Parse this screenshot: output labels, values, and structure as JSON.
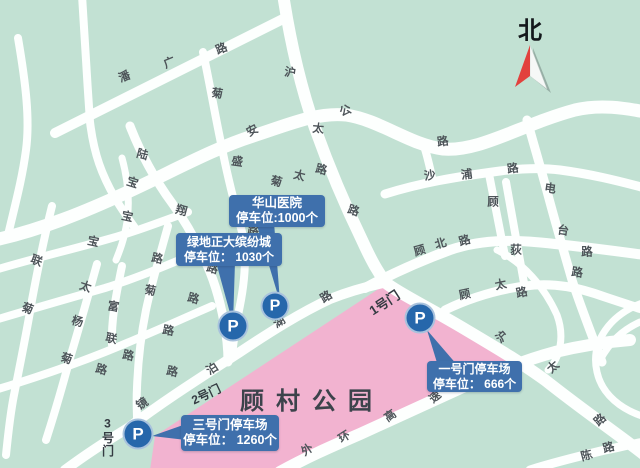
{
  "map": {
    "title": "顾村公园",
    "north_label": "北",
    "parking_letter": "P",
    "gates": {
      "g1": "1号门",
      "g2": "2号门",
      "g3": "3号门"
    },
    "callouts": {
      "huashan": {
        "line1": "华山医院",
        "line2": "停车位:1000个"
      },
      "lvdi": {
        "line1": "绿地正大缤纷城",
        "line2": "停车位： 1030个"
      },
      "gate3": {
        "line1": "三号门停车场",
        "line2": "停车位： 1260个"
      },
      "gate1": {
        "line1": "一号门停车场",
        "line2": "停车位： 666个"
      }
    },
    "colors": {
      "bg": "#c2e1d3",
      "road": "#fdfffe",
      "park": "#f2b3d0",
      "callout": "#3f70ac",
      "p-blue": "#2667ab",
      "compass-red": "#e2413d",
      "ink": "#343b42",
      "road-label": "#4d5459",
      "title": "#3c434b"
    },
    "road_labels": [
      {
        "t": "潘",
        "x": 125,
        "y": 78,
        "r": -22,
        "road": "潘广路"
      },
      {
        "t": "广",
        "x": 170,
        "y": 64,
        "r": -22,
        "road": "潘广路"
      },
      {
        "t": "路",
        "x": 222,
        "y": 50,
        "r": -22,
        "road": "潘广路"
      },
      {
        "t": "沪",
        "x": 290,
        "y": 74,
        "r": 8,
        "road": "沪太公路"
      },
      {
        "t": "太",
        "x": 318,
        "y": 130,
        "r": 5,
        "road": "沪太公路"
      },
      {
        "t": "路",
        "x": 353,
        "y": 212,
        "r": 18,
        "road": "沪太公路"
      },
      {
        "t": "沪",
        "x": 503,
        "y": 338,
        "r": -42,
        "road": "沪太公路"
      },
      {
        "t": "太",
        "x": 554,
        "y": 368,
        "r": -42,
        "road": "沪太公路"
      },
      {
        "t": "路",
        "x": 601,
        "y": 421,
        "r": -42,
        "road": "沪太公路"
      },
      {
        "t": "宝",
        "x": 132,
        "y": 184,
        "r": 18,
        "road": "宝安公路"
      },
      {
        "t": "安",
        "x": 253,
        "y": 132,
        "r": -28,
        "road": "宝安公路"
      },
      {
        "t": "公",
        "x": 346,
        "y": 112,
        "r": -22,
        "road": "宝安公路"
      },
      {
        "t": "路",
        "x": 443,
        "y": 143,
        "r": -8,
        "road": "宝安公路"
      },
      {
        "t": "菊",
        "x": 217,
        "y": 95,
        "r": 8,
        "road": "菊盛路"
      },
      {
        "t": "盛",
        "x": 237,
        "y": 163,
        "r": 8,
        "road": "菊盛路"
      },
      {
        "t": "路",
        "x": 253,
        "y": 232,
        "r": 8,
        "road": "菊盛路"
      },
      {
        "t": "陆",
        "x": 142,
        "y": 156,
        "r": 15,
        "road": "陆翔路"
      },
      {
        "t": "翔",
        "x": 181,
        "y": 212,
        "r": 15,
        "road": "陆翔路"
      },
      {
        "t": "路",
        "x": 212,
        "y": 270,
        "r": 15,
        "road": "陆翔路"
      },
      {
        "t": "宝",
        "x": 127,
        "y": 218,
        "r": 12,
        "road": ""
      },
      {
        "t": "路",
        "x": 157,
        "y": 260,
        "r": 12,
        "road": ""
      },
      {
        "t": "菊",
        "x": 276,
        "y": 183,
        "r": 14,
        "road": "菊太路"
      },
      {
        "t": "太",
        "x": 299,
        "y": 177,
        "r": 14,
        "road": "菊太路"
      },
      {
        "t": "路",
        "x": 321,
        "y": 171,
        "r": 14,
        "road": "菊太路"
      },
      {
        "t": "联",
        "x": 36,
        "y": 262,
        "r": 20,
        "road": "菊联路"
      },
      {
        "t": "菊",
        "x": 27,
        "y": 310,
        "r": 20,
        "road": "菊联路"
      },
      {
        "t": "宝",
        "x": 93,
        "y": 243,
        "r": 12,
        "road": ""
      },
      {
        "t": "太",
        "x": 85,
        "y": 288,
        "r": 18,
        "road": ""
      },
      {
        "t": "杨",
        "x": 77,
        "y": 323,
        "r": 15,
        "road": ""
      },
      {
        "t": "菊",
        "x": 66,
        "y": 360,
        "r": 18,
        "road": ""
      },
      {
        "t": "富",
        "x": 113,
        "y": 308,
        "r": 10,
        "road": "富联路"
      },
      {
        "t": "联",
        "x": 111,
        "y": 340,
        "r": 12,
        "road": "富联路"
      },
      {
        "t": "路",
        "x": 128,
        "y": 357,
        "r": 12,
        "road": "富联路"
      },
      {
        "t": "路",
        "x": 101,
        "y": 371,
        "r": 15,
        "road": ""
      },
      {
        "t": "菊",
        "x": 150,
        "y": 292,
        "r": 10,
        "road": ""
      },
      {
        "t": "路",
        "x": 168,
        "y": 332,
        "r": 10,
        "road": ""
      },
      {
        "t": "路",
        "x": 172,
        "y": 373,
        "r": 12,
        "road": ""
      },
      {
        "t": "路",
        "x": 193,
        "y": 300,
        "r": 15,
        "road": ""
      },
      {
        "t": "沙",
        "x": 430,
        "y": 177,
        "r": -8,
        "road": "沙浦路"
      },
      {
        "t": "浦",
        "x": 467,
        "y": 176,
        "r": -8,
        "road": "沙浦路"
      },
      {
        "t": "路",
        "x": 513,
        "y": 170,
        "r": -8,
        "road": "沙浦路"
      },
      {
        "t": "顾",
        "x": 420,
        "y": 252,
        "r": -16,
        "road": "顾北路"
      },
      {
        "t": "北",
        "x": 441,
        "y": 245,
        "r": -16,
        "road": "顾北路"
      },
      {
        "t": "路",
        "x": 465,
        "y": 242,
        "r": -16,
        "road": "顾北路"
      },
      {
        "t": "顾",
        "x": 493,
        "y": 203,
        "r": 0,
        "road": ""
      },
      {
        "t": "电",
        "x": 550,
        "y": 190,
        "r": 8,
        "road": "电台路"
      },
      {
        "t": "台",
        "x": 563,
        "y": 232,
        "r": 8,
        "road": "电台路"
      },
      {
        "t": "路",
        "x": 577,
        "y": 274,
        "r": 8,
        "road": "电台路"
      },
      {
        "t": "荻",
        "x": 516,
        "y": 251,
        "r": 0,
        "road": ""
      },
      {
        "t": "路",
        "x": 587,
        "y": 253,
        "r": 0,
        "road": ""
      },
      {
        "t": "镜",
        "x": 143,
        "y": 405,
        "r": -33,
        "road": "镜泊湖路"
      },
      {
        "t": "泊",
        "x": 213,
        "y": 370,
        "r": -33,
        "road": "镜泊湖路"
      },
      {
        "t": "湖",
        "x": 280,
        "y": 323,
        "r": -33,
        "road": "镜泊湖路"
      },
      {
        "t": "路",
        "x": 327,
        "y": 298,
        "r": -33,
        "road": "镜泊湖路"
      },
      {
        "t": "顾",
        "x": 465,
        "y": 296,
        "r": -12,
        "road": "顾太路"
      },
      {
        "t": "太",
        "x": 501,
        "y": 286,
        "r": -12,
        "road": "顾太路"
      },
      {
        "t": "路",
        "x": 522,
        "y": 294,
        "r": -12,
        "road": "顾太路"
      },
      {
        "t": "外",
        "x": 308,
        "y": 451,
        "r": -35,
        "road": "外环高速"
      },
      {
        "t": "环",
        "x": 345,
        "y": 438,
        "r": -32,
        "road": "外环高速"
      },
      {
        "t": "高",
        "x": 391,
        "y": 417,
        "r": -35,
        "road": "外环高速"
      },
      {
        "t": "速",
        "x": 436,
        "y": 398,
        "r": -40,
        "road": "外环高速"
      },
      {
        "t": "陈",
        "x": 587,
        "y": 457,
        "r": -15,
        "road": "陈路"
      },
      {
        "t": "路",
        "x": 609,
        "y": 449,
        "r": -15,
        "road": "陈路"
      }
    ]
  }
}
